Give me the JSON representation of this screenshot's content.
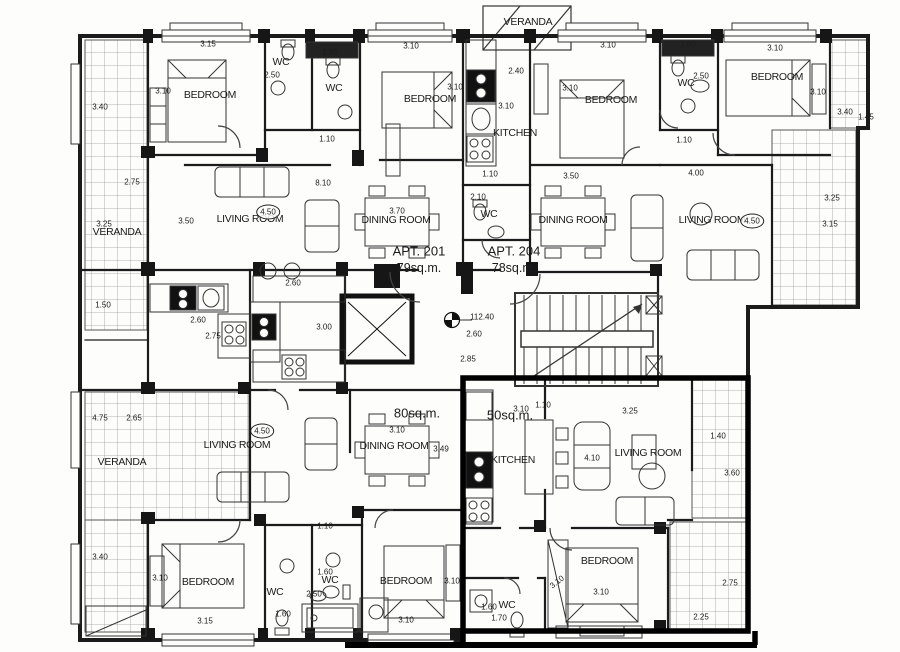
{
  "drawing_type": "architectural floor plan",
  "highlight": {
    "outlined_apartment_area": "50sq.m.",
    "color": "#000000"
  },
  "colors": {
    "paper": "#fdfdfc",
    "ink": "#1b1b1b",
    "hatch": "#9a9a9a",
    "highlight": "#000000"
  },
  "apt_labels": [
    {
      "line1": "APT. 201",
      "line2": "79sq.m.",
      "x": 419,
      "y": 251
    },
    {
      "line1": "APT. 204",
      "line2": "78sq.m.",
      "x": 514,
      "y": 251
    },
    {
      "line1": "80sq.m.",
      "line2": "",
      "x": 417,
      "y": 413
    },
    {
      "line1": "50sq.m.",
      "line2": "",
      "x": 510,
      "y": 415
    }
  ],
  "rooms": [
    {
      "t": "VERANDA",
      "x": 528,
      "y": 22
    },
    {
      "t": "BEDROOM",
      "x": 210,
      "y": 95
    },
    {
      "t": "WC",
      "x": 281,
      "y": 62
    },
    {
      "t": "WC",
      "x": 334,
      "y": 88
    },
    {
      "t": "BEDROOM",
      "x": 430,
      "y": 99
    },
    {
      "t": "KITCHEN",
      "x": 515,
      "y": 133
    },
    {
      "t": "WC",
      "x": 489,
      "y": 214
    },
    {
      "t": "BEDROOM",
      "x": 611,
      "y": 100
    },
    {
      "t": "WC",
      "x": 686,
      "y": 83
    },
    {
      "t": "BEDROOM",
      "x": 777,
      "y": 77
    },
    {
      "t": "VERANDA",
      "x": 117,
      "y": 232
    },
    {
      "t": "LIVING ROOM",
      "x": 250,
      "y": 219
    },
    {
      "t": "DINING ROOM",
      "x": 396,
      "y": 220
    },
    {
      "t": "DINING ROOM",
      "x": 573,
      "y": 220
    },
    {
      "t": "LIVING ROOM",
      "x": 712,
      "y": 220
    },
    {
      "t": "VERANDA",
      "x": 122,
      "y": 462
    },
    {
      "t": "LIVING ROOM",
      "x": 237,
      "y": 445
    },
    {
      "t": "DINING ROOM",
      "x": 394,
      "y": 446
    },
    {
      "t": "KITCHEN",
      "x": 513,
      "y": 460
    },
    {
      "t": "LIVING ROOM",
      "x": 648,
      "y": 453
    },
    {
      "t": "BEDROOM",
      "x": 208,
      "y": 582
    },
    {
      "t": "WC",
      "x": 275,
      "y": 592
    },
    {
      "t": "WC",
      "x": 330,
      "y": 580
    },
    {
      "t": "BEDROOM",
      "x": 406,
      "y": 581
    },
    {
      "t": "BEDROOM",
      "x": 607,
      "y": 561
    },
    {
      "t": "WC",
      "x": 507,
      "y": 605
    }
  ],
  "dims": [
    {
      "v": "3.15",
      "x": 208,
      "y": 44
    },
    {
      "v": "1.60",
      "x": 330,
      "y": 52
    },
    {
      "v": "3.10",
      "x": 411,
      "y": 46
    },
    {
      "v": "3.10",
      "x": 608,
      "y": 45
    },
    {
      "v": "1.60",
      "x": 688,
      "y": 44
    },
    {
      "v": "3.10",
      "x": 775,
      "y": 48
    },
    {
      "v": "2.50",
      "x": 272,
      "y": 75
    },
    {
      "v": "2.40",
      "x": 516,
      "y": 71
    },
    {
      "v": "2.50",
      "x": 701,
      "y": 76
    },
    {
      "v": "3.40",
      "x": 100,
      "y": 107
    },
    {
      "v": "3.10",
      "x": 163,
      "y": 91
    },
    {
      "v": "3.10",
      "x": 455,
      "y": 87
    },
    {
      "v": "3.10",
      "x": 570,
      "y": 88
    },
    {
      "v": "3.10",
      "x": 818,
      "y": 92
    },
    {
      "v": "3.40",
      "x": 845,
      "y": 112
    },
    {
      "v": "1.45",
      "x": 866,
      "y": 117
    },
    {
      "v": "3.10",
      "x": 506,
      "y": 106
    },
    {
      "v": "1.10",
      "x": 327,
      "y": 139
    },
    {
      "v": "1.10",
      "x": 684,
      "y": 140
    },
    {
      "v": "1.10",
      "x": 490,
      "y": 174
    },
    {
      "v": "3.50",
      "x": 571,
      "y": 176
    },
    {
      "v": "4.00",
      "x": 696,
      "y": 173
    },
    {
      "v": "8.10",
      "x": 323,
      "y": 183
    },
    {
      "v": "2.75",
      "x": 132,
      "y": 182
    },
    {
      "v": "3.25",
      "x": 104,
      "y": 224
    },
    {
      "v": "3.50",
      "x": 186,
      "y": 221
    },
    {
      "v": "2.10",
      "x": 478,
      "y": 197
    },
    {
      "v": "3.70",
      "x": 397,
      "y": 211
    },
    {
      "v": "3.25",
      "x": 832,
      "y": 198
    },
    {
      "v": "3.15",
      "x": 830,
      "y": 224
    },
    {
      "v": "1.50",
      "x": 103,
      "y": 305
    },
    {
      "v": "2.60",
      "x": 293,
      "y": 283
    },
    {
      "v": "2.60",
      "x": 198,
      "y": 320
    },
    {
      "v": "2.75",
      "x": 213,
      "y": 336
    },
    {
      "v": "3.00",
      "x": 324,
      "y": 327
    },
    {
      "v": "112.40",
      "x": 482,
      "y": 317
    },
    {
      "v": "2.60",
      "x": 474,
      "y": 334
    },
    {
      "v": "2.85",
      "x": 468,
      "y": 359
    },
    {
      "v": "4.75",
      "x": 100,
      "y": 418
    },
    {
      "v": "2.65",
      "x": 134,
      "y": 418
    },
    {
      "v": "3.10",
      "x": 397,
      "y": 430
    },
    {
      "v": "3.49",
      "x": 441,
      "y": 449
    },
    {
      "v": "3.10",
      "x": 521,
      "y": 409
    },
    {
      "v": "1.10",
      "x": 543,
      "y": 405
    },
    {
      "v": "3.25",
      "x": 630,
      "y": 411
    },
    {
      "v": "4.10",
      "x": 592,
      "y": 458
    },
    {
      "v": "1.40",
      "x": 718,
      "y": 436
    },
    {
      "v": "3.60",
      "x": 732,
      "y": 473
    },
    {
      "v": "3.40",
      "x": 100,
      "y": 557
    },
    {
      "v": "3.10",
      "x": 160,
      "y": 578
    },
    {
      "v": "3.10",
      "x": 452,
      "y": 581
    },
    {
      "v": "1.10",
      "x": 325,
      "y": 526
    },
    {
      "v": "1.60",
      "x": 325,
      "y": 572
    },
    {
      "v": "2.50",
      "x": 314,
      "y": 594
    },
    {
      "v": "3.15",
      "x": 205,
      "y": 621
    },
    {
      "v": "1.60",
      "x": 283,
      "y": 614
    },
    {
      "v": "3.10",
      "x": 406,
      "y": 620
    },
    {
      "v": "3.10",
      "x": 557,
      "y": 582,
      "r": -38
    },
    {
      "v": "3.10",
      "x": 601,
      "y": 592
    },
    {
      "v": "1.60",
      "x": 489,
      "y": 607
    },
    {
      "v": "1.70",
      "x": 499,
      "y": 618
    },
    {
      "v": "2.75",
      "x": 730,
      "y": 583
    },
    {
      "v": "2.25",
      "x": 701,
      "y": 617
    }
  ],
  "circled": [
    {
      "v": "4.50",
      "x": 268,
      "y": 212
    },
    {
      "v": "4.50",
      "x": 752,
      "y": 221
    },
    {
      "v": "4.50",
      "x": 262,
      "y": 431
    }
  ],
  "level_marker": {
    "value": "112.40"
  }
}
